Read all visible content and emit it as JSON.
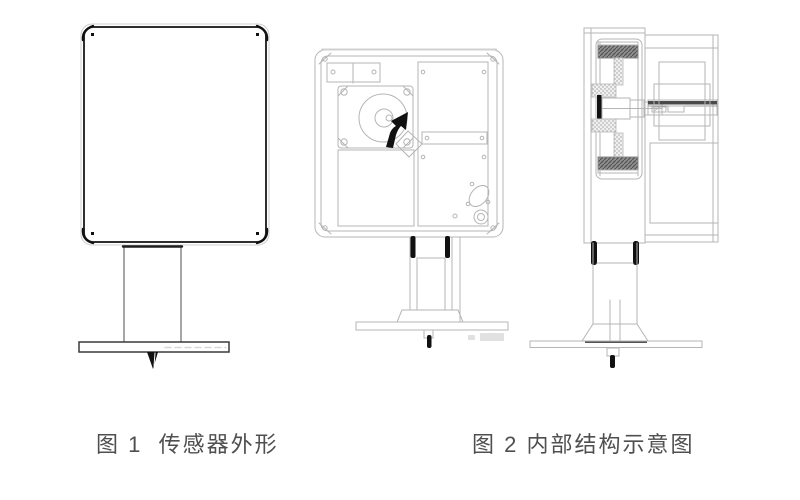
{
  "document": {
    "background": "#ffffff",
    "captions": {
      "fig1": "图 1  传感器外形",
      "fig2": "图 2 内部结构示意图"
    },
    "colors": {
      "caption_text": "#4f4f4f",
      "drawing_line_light": "#b5b5b5",
      "drawing_line_medium": "#8f8f8f",
      "drawing_line_dark": "#2f2f2f",
      "solid_black_parts": "#111111",
      "hatch_fill": "#8d8d8d",
      "stipple_fill": "#f0f0f0"
    }
  }
}
